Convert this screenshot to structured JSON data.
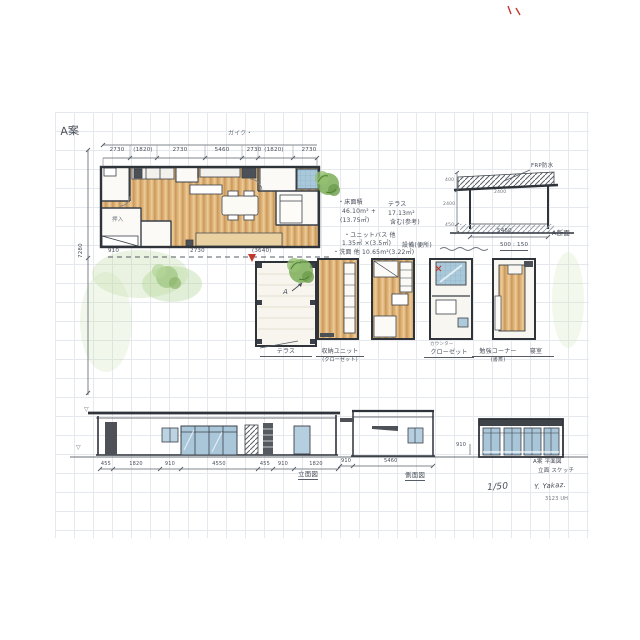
{
  "sheet": {
    "plan_label": "A案"
  },
  "plan": {
    "dim_title": "ガイク・",
    "top_dims": [
      "2730",
      "(1820)",
      "2730",
      "5460",
      "2730",
      "(1820)",
      "2730"
    ],
    "left_dim": "7280",
    "bottom_dims": [
      "910",
      "2730",
      "(3640)"
    ],
    "interior_note": "押入"
  },
  "area_notes": {
    "r1l": "・床面積",
    "r1r": "テラス",
    "r2l": "46.10m² +",
    "r2r": "17.13m²",
    "r3l": "(13.75㎡)",
    "r3r": "含む(参考)",
    "r4": "・ユニットバス 他",
    "r5l": "1.35㎡ ×(3.5㎡)",
    "r5r": "設備(便所)",
    "r6": "・洗面 他 10.65m²(3.22㎡)"
  },
  "details": {
    "marker": "A",
    "label1": "テラス",
    "label2": "収納ユニット",
    "sub2": "(クローゼット)",
    "label3": "クローゼット",
    "sub3": "カウンター",
    "label4": "勉強コーナー",
    "sub4": "(書斎)",
    "label5": "寝室"
  },
  "section": {
    "roof_note": "FRP防水",
    "eave_dim": "2400",
    "left_dims": [
      "400",
      "2400",
      "450"
    ],
    "bottom_dim": "5460",
    "label": "A断面",
    "memo": "500 : 150"
  },
  "elevations": {
    "south": {
      "dims": [
        "455",
        "1820",
        "910",
        "4550",
        "455",
        "910",
        "1820"
      ],
      "label": "立面図",
      "tri1": "▽",
      "tri2": "▽"
    },
    "side": {
      "sub_dim": "910",
      "dim": "5460",
      "label": "側面図"
    },
    "front": {
      "sub_dim": "910"
    }
  },
  "titleblock": {
    "line1": "A案 平面図",
    "line2": "立面 スケッチ",
    "scale": "1/50",
    "sign": "Y. Yakaz.",
    "code": "3123 UH"
  },
  "colors": {
    "ink": "#3b4048",
    "wood": "#dcb075",
    "glass": "#aac7da",
    "accent_red": "#c0392b",
    "green": "#7cae58"
  }
}
